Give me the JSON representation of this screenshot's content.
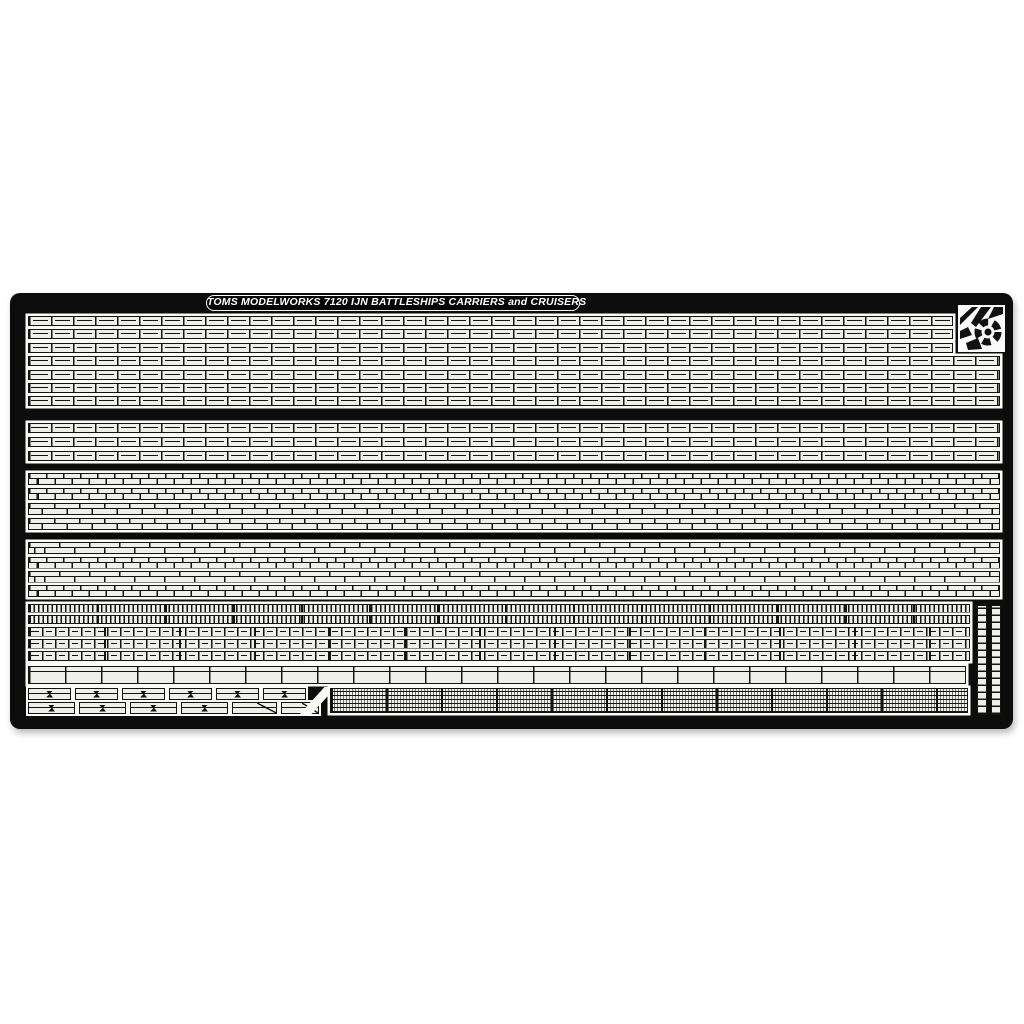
{
  "meta": {
    "kind": "product photo of a photo-etched brass model detail set",
    "image_width": 1024,
    "image_height": 1024
  },
  "colors": {
    "page_background": "#ffffff",
    "fret": "#0c0c0c",
    "etch_line": "#131313",
    "metal_fill": "#efefec",
    "metal_slab": "#fbfbf8",
    "title_text": "#ffffff"
  },
  "fret": {
    "x": 10,
    "y": 293,
    "width": 1003,
    "height": 436,
    "corner_radius": 10
  },
  "title": {
    "text": "TOMS MODELWORKS 7120 IJN BATTLESHIPS CARRIERS and CRUISERS",
    "x": 196,
    "y": 2,
    "width": 372,
    "height": 14
  },
  "logo": {
    "x": 948,
    "y": 12,
    "width": 47,
    "height": 47
  },
  "railing_bands": [
    {
      "name": "three-bar-railing-band-1",
      "rows": [
        {
          "x": 18,
          "y": 23,
          "w": 925,
          "h": 10,
          "pitch": 22,
          "mids": [
            {
              "pos": 0.5,
              "dash": true
            }
          ]
        },
        {
          "x": 18,
          "y": 36,
          "w": 925,
          "h": 10,
          "pitch": 22,
          "mids": [
            {
              "pos": 0.5,
              "dash": true
            }
          ]
        },
        {
          "x": 18,
          "y": 50,
          "w": 925,
          "h": 10,
          "pitch": 22,
          "mids": [
            {
              "pos": 0.5,
              "dash": true
            }
          ]
        },
        {
          "x": 18,
          "y": 63,
          "w": 972,
          "h": 10,
          "pitch": 22,
          "mids": [
            {
              "pos": 0.5,
              "dash": true
            }
          ]
        },
        {
          "x": 18,
          "y": 77,
          "w": 972,
          "h": 10,
          "pitch": 22,
          "mids": [
            {
              "pos": 0.5,
              "dash": true
            }
          ]
        },
        {
          "x": 18,
          "y": 90,
          "w": 972,
          "h": 10,
          "pitch": 22,
          "mids": [
            {
              "pos": 0.5,
              "dash": true
            }
          ]
        },
        {
          "x": 18,
          "y": 103,
          "w": 972,
          "h": 10,
          "pitch": 22,
          "mids": [
            {
              "pos": 0.5,
              "dash": true
            }
          ]
        }
      ]
    },
    {
      "name": "three-bar-railing-band-2",
      "rows": [
        {
          "x": 18,
          "y": 130,
          "w": 972,
          "h": 10,
          "pitch": 22,
          "mids": [
            {
              "pos": 0.5,
              "dash": true
            }
          ]
        },
        {
          "x": 18,
          "y": 144,
          "w": 972,
          "h": 10,
          "pitch": 22,
          "mids": [
            {
              "pos": 0.5,
              "dash": true
            }
          ]
        },
        {
          "x": 18,
          "y": 158,
          "w": 972,
          "h": 10,
          "pitch": 22,
          "mids": [
            {
              "pos": 0.5,
              "dash": true
            }
          ]
        }
      ]
    },
    {
      "name": "two-bar-railing-band-3",
      "rows": [
        {
          "x": 18,
          "y": 180,
          "w": 972,
          "h": 12,
          "pitch": 17,
          "brick": true
        },
        {
          "x": 18,
          "y": 195,
          "w": 972,
          "h": 12,
          "pitch": 17,
          "brick": true
        },
        {
          "x": 18,
          "y": 210,
          "w": 972,
          "h": 12,
          "pitch": 25,
          "brick": true
        },
        {
          "x": 18,
          "y": 225,
          "w": 972,
          "h": 12,
          "pitch": 25,
          "brick": true
        }
      ]
    },
    {
      "name": "two-bar-railing-band-4",
      "rows": [
        {
          "x": 18,
          "y": 249,
          "w": 972,
          "h": 12,
          "pitch": 30,
          "brick": true
        },
        {
          "x": 18,
          "y": 264,
          "w": 972,
          "h": 12,
          "pitch": 17,
          "brick": true
        },
        {
          "x": 18,
          "y": 278,
          "w": 972,
          "h": 12,
          "pitch": 30,
          "brick": true
        },
        {
          "x": 18,
          "y": 292,
          "w": 972,
          "h": 12,
          "pitch": 17,
          "brick": true
        }
      ]
    },
    {
      "name": "fine-and-mixed-band-5",
      "rows": [
        {
          "x": 18,
          "y": 311,
          "w": 942,
          "h": 9,
          "pitch": 4.5,
          "heavy": 68
        },
        {
          "x": 18,
          "y": 322,
          "w": 942,
          "h": 9,
          "pitch": 4.5,
          "heavy": 68
        },
        {
          "x": 18,
          "y": 334,
          "w": 942,
          "h": 10,
          "pitch": 13,
          "heavy": 75,
          "mids": [
            {
              "pos": 0.5,
              "dash": true
            }
          ]
        },
        {
          "x": 18,
          "y": 346,
          "w": 942,
          "h": 10,
          "pitch": 13,
          "heavy": 75,
          "mids": [
            {
              "pos": 0.5,
              "dash": true
            }
          ]
        },
        {
          "x": 18,
          "y": 358,
          "w": 942,
          "h": 10,
          "pitch": 13,
          "heavy": 75,
          "mids": [
            {
              "pos": 0.5,
              "dash": true
            }
          ]
        },
        {
          "x": 18,
          "y": 373,
          "w": 938,
          "h": 18,
          "pitch": 36,
          "mids": [
            {
              "pos": 0.28,
              "dash": false
            }
          ]
        }
      ]
    }
  ],
  "ladders": [
    {
      "x": 967,
      "y": 312,
      "w": 10,
      "h": 110,
      "rung_pitch": 7
    },
    {
      "x": 981,
      "y": 312,
      "w": 10,
      "h": 110,
      "rung_pitch": 7
    }
  ],
  "small_parts_rows": [
    {
      "name": "bracket-parts-row-upper",
      "y": 395,
      "h": 12,
      "pieces": [
        {
          "x": 18,
          "w": 43,
          "type": "clip"
        },
        {
          "x": 65,
          "w": 43,
          "type": "clip"
        },
        {
          "x": 112,
          "w": 43,
          "type": "clip"
        },
        {
          "x": 159,
          "w": 43,
          "type": "clip"
        },
        {
          "x": 206,
          "w": 43,
          "type": "clip"
        },
        {
          "x": 253,
          "w": 43,
          "type": "clip"
        }
      ]
    },
    {
      "name": "bracket-parts-row-lower",
      "y": 409,
      "h": 12,
      "pieces": [
        {
          "x": 18,
          "w": 47,
          "type": "clip"
        },
        {
          "x": 69,
          "w": 47,
          "type": "clip"
        },
        {
          "x": 120,
          "w": 47,
          "type": "clip"
        },
        {
          "x": 171,
          "w": 47,
          "type": "clip"
        },
        {
          "x": 222,
          "w": 45,
          "type": "diagonal"
        },
        {
          "x": 271,
          "w": 38,
          "type": "diagonal"
        }
      ]
    }
  ],
  "diagonal_sprue": {
    "x": 290,
    "y": 394,
    "w": 36,
    "h": 27
  },
  "strip_block": {
    "x": 320,
    "y": 395,
    "w": 638,
    "h": 25,
    "row_pitch": 4,
    "dash_pitch": 3,
    "heavy": 55
  }
}
